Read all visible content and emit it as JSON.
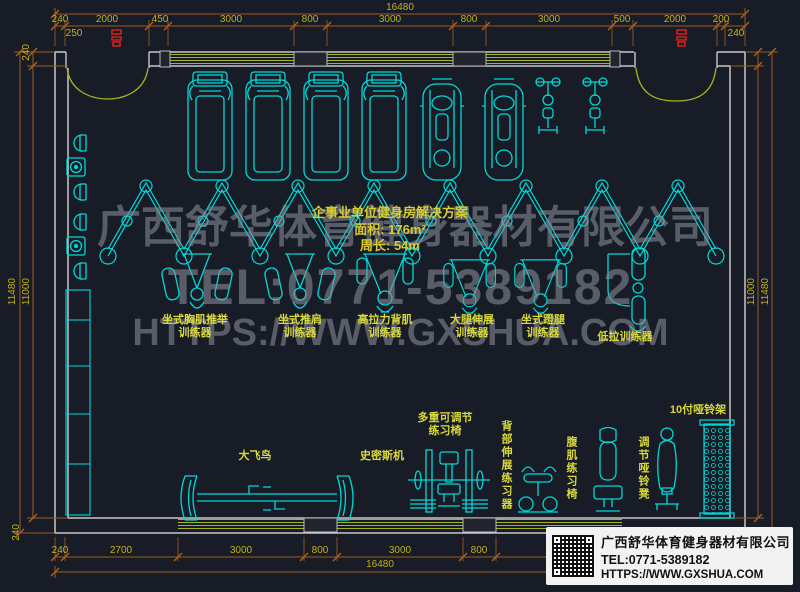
{
  "meta": {
    "drawing_type": "gym floor plan (CAD)",
    "colors": {
      "background": "#171c26",
      "equipment_cyan": "#00d9d9",
      "wall_gray": "#d4d4d4",
      "window_green": "#a7b420",
      "dimension_orange": "#9c5a20",
      "dimension_text": "#c2b11c",
      "label_yellow": "#d9d93c",
      "watermark_gray": "#878d98",
      "marker_red": "#d42020"
    }
  },
  "title_block": {
    "line1": "企事业单位健身房解决方案",
    "line2": "面积: 176m²",
    "line3": "周长: 54m"
  },
  "watermark": {
    "line1": "广西舒华体育健身器材有限公司",
    "line2": "TEL:0771-5389182",
    "line3": "HTTPS://WWW.GXSHUA.COM"
  },
  "dimensions": {
    "top": {
      "overall": "16480",
      "segments": [
        "240",
        "2000",
        "450",
        "3000",
        "800",
        "3000",
        "800",
        "3000",
        "500",
        "2000",
        "200"
      ],
      "sub_left": "250",
      "sub_right": "240"
    },
    "bottom": {
      "overall": "16480",
      "segments": [
        "240",
        "2700",
        "3000",
        "800",
        "3000",
        "800"
      ],
      "corner": "240"
    },
    "left": {
      "top": "240",
      "outer": "11480",
      "inner": "11000"
    },
    "right": {
      "inner": "11000",
      "outer": "11480"
    }
  },
  "equipment_labels": {
    "chest_press": {
      "l1": "坐式胸肌推举",
      "l2": "训练器"
    },
    "shoulder_press": {
      "l1": "坐式推肩",
      "l2": "训练器"
    },
    "lat_pulldown": {
      "l1": "高拉力背肌",
      "l2": "训练器"
    },
    "leg_extension": {
      "l1": "大腿伸展",
      "l2": "训练器"
    },
    "leg_press": {
      "l1": "坐式蹬腿",
      "l2": "训练器"
    },
    "low_row": "低拉训练器",
    "cable_fly": "大飞鸟",
    "smith_machine": "史密斯机",
    "adjustable_bench": {
      "l1": "多重可调节",
      "l2": "练习椅"
    },
    "back_extension": "背部伸展练习器",
    "ab_bench": "腹肌练习椅",
    "adjustable_dumbbell_bench": "调节哑铃凳",
    "dumbbell_rack": "10付哑铃架"
  },
  "info_card": {
    "company": "广西舒华体育健身器材有限公司",
    "tel": "TEL:0771-5389182",
    "web": "HTTPS://WWW.GXSHUA.COM"
  }
}
